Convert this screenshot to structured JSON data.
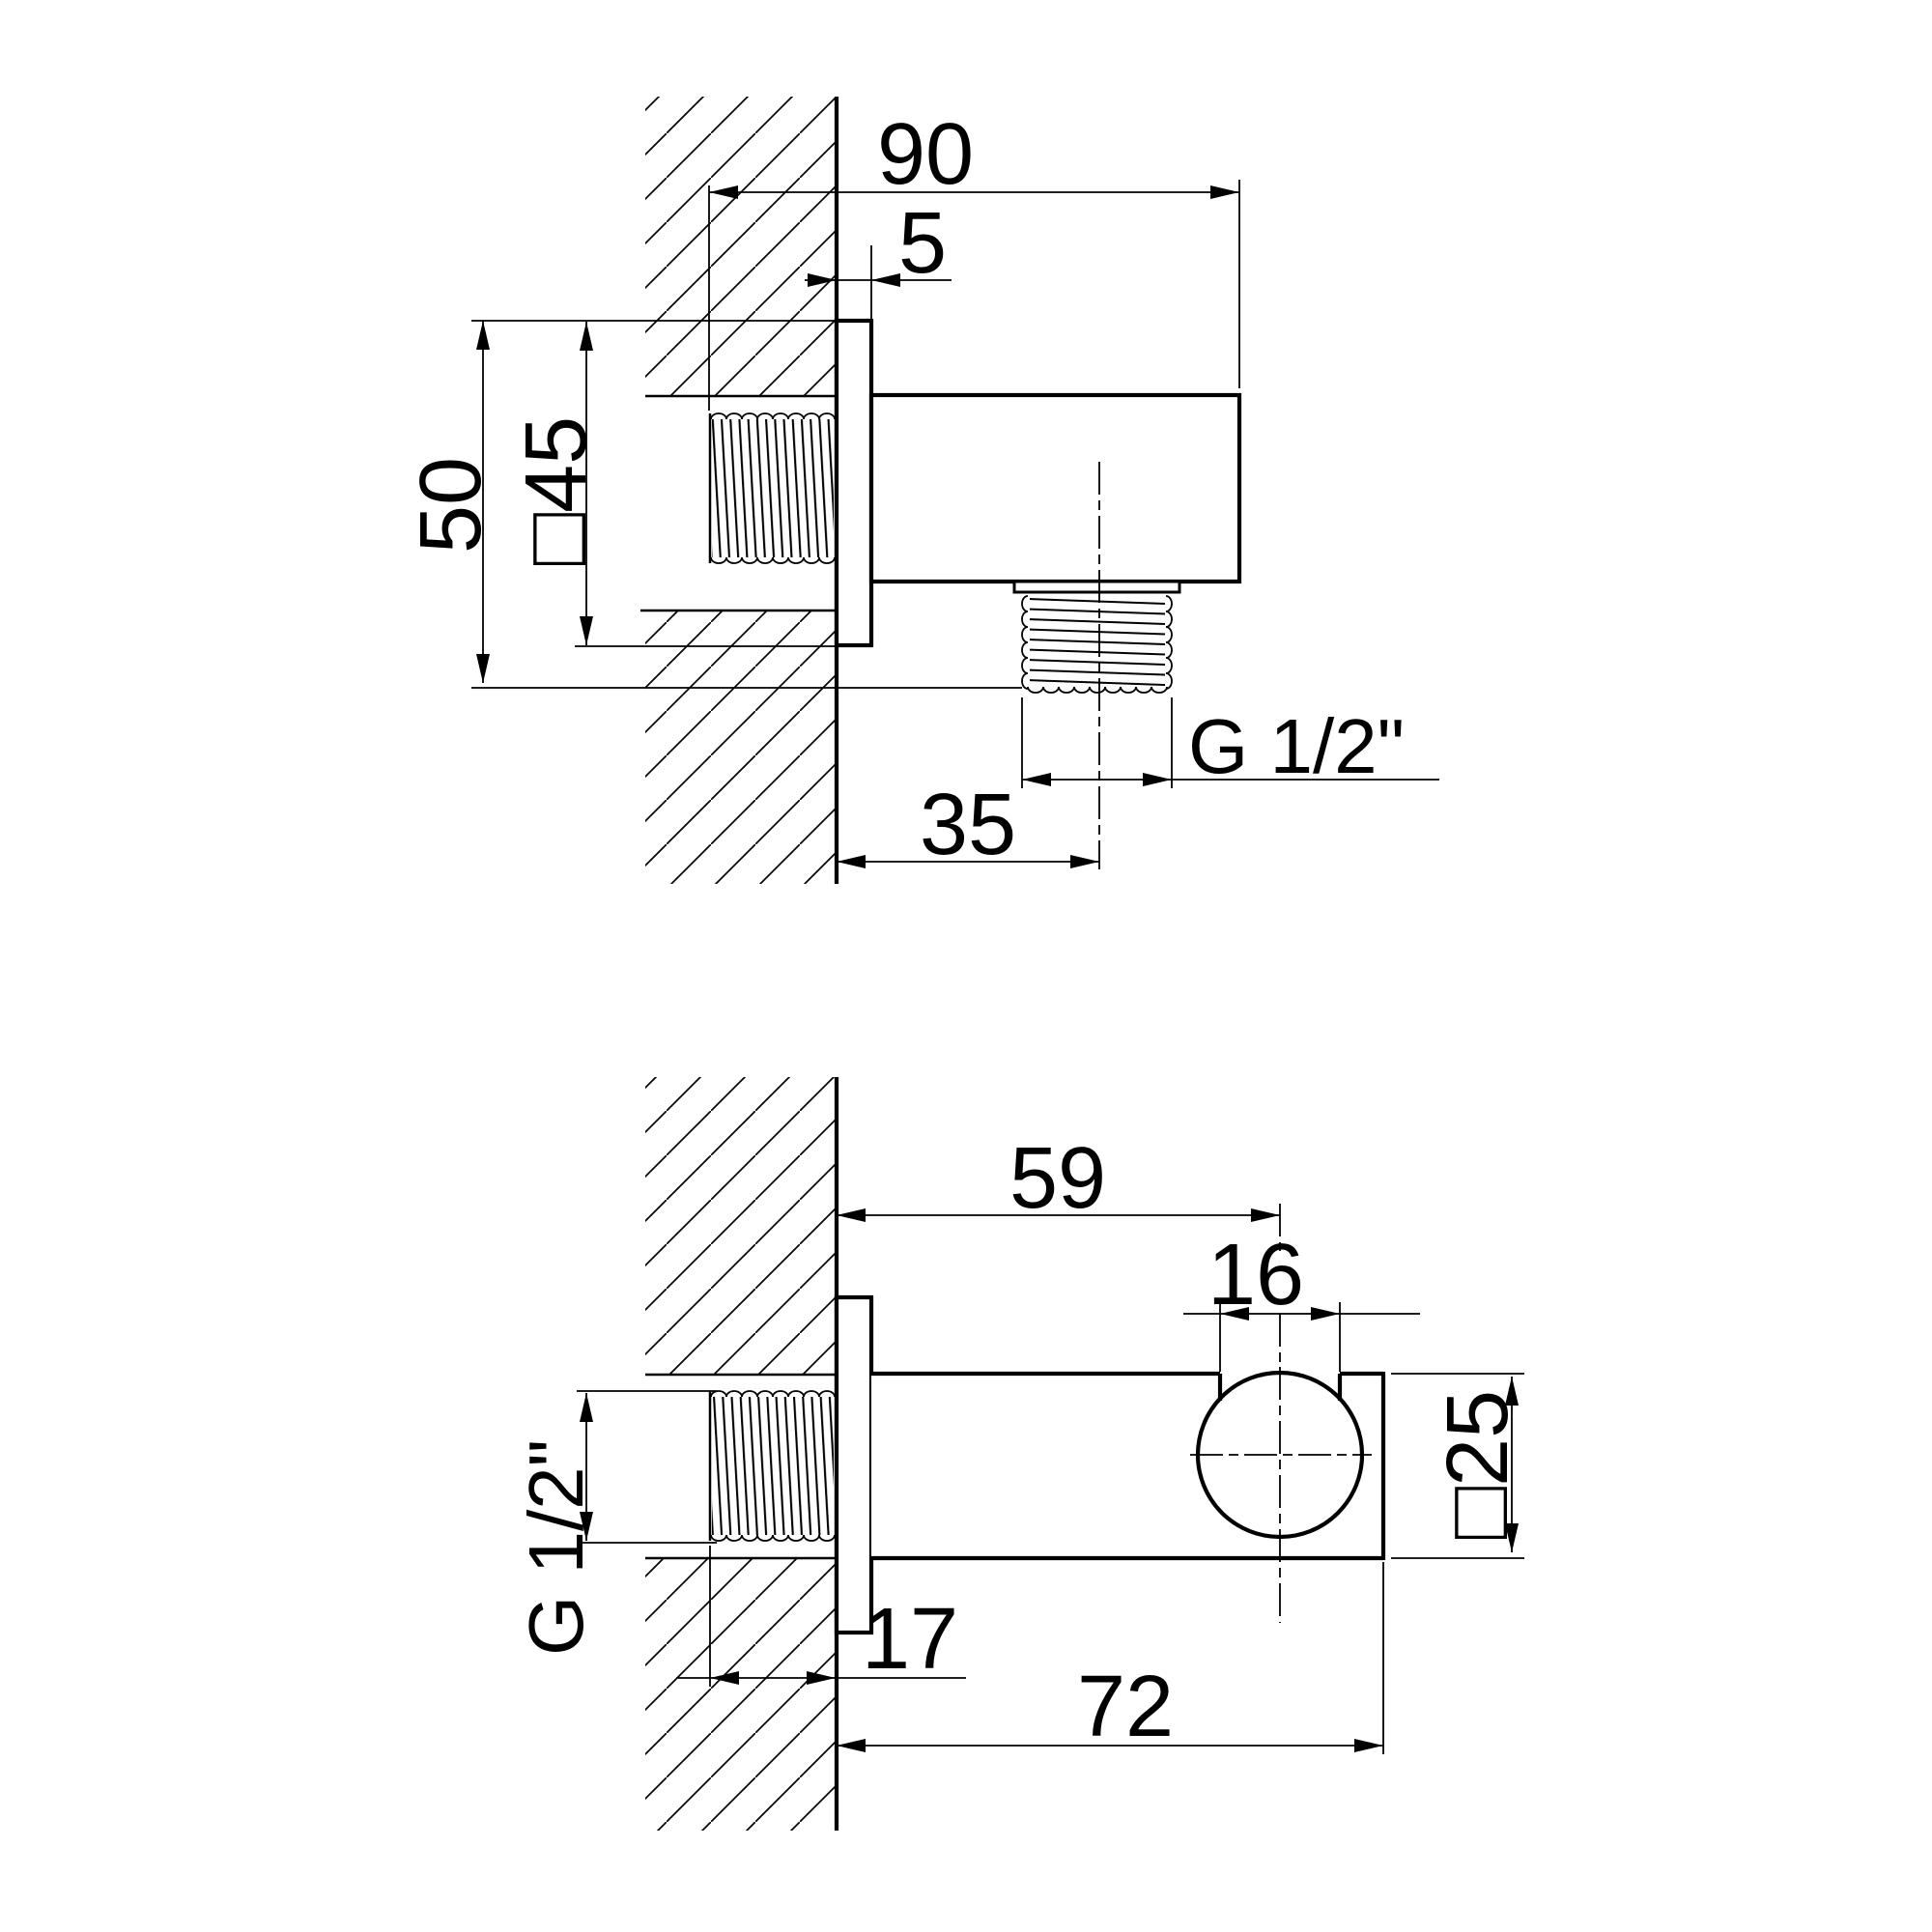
{
  "document": {
    "type": "technical-dimension-drawing",
    "background_color": "#ffffff",
    "line_color": "#000000"
  },
  "views": {
    "top": {
      "name": "side section view",
      "dims": {
        "overall_width": "90",
        "flange_thickness": "5",
        "overall_height": "50",
        "flange_square": "□45",
        "outlet_center_offset": "35",
        "outlet_thread": "G 1/2\""
      }
    },
    "bottom": {
      "name": "plan section view",
      "dims": {
        "center_from_wall": "59",
        "socket_width": "16",
        "thread_length": "17",
        "overall_length": "72",
        "body_square": "□25",
        "inlet_thread": "G 1/2\""
      }
    }
  }
}
